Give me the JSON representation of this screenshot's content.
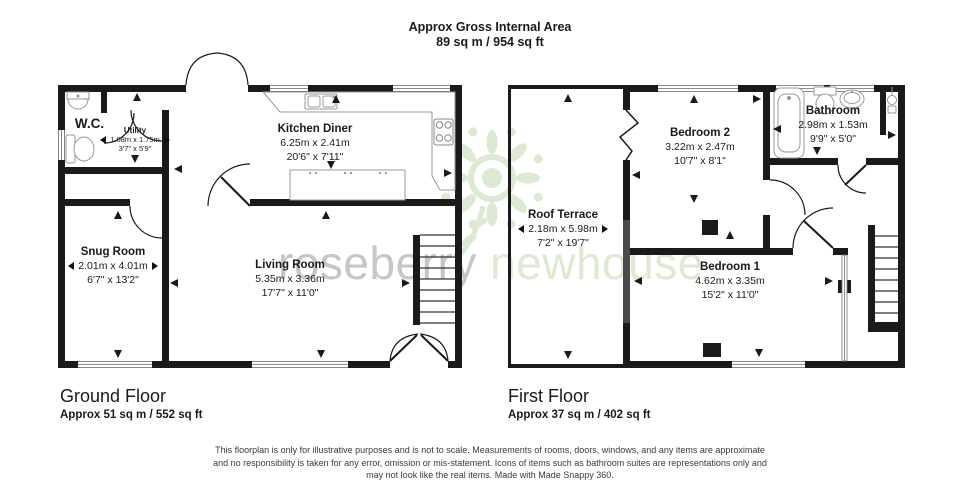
{
  "header": {
    "line1": "Approx Gross Internal Area",
    "line2": "89 sq m / 954 sq ft"
  },
  "watermark": {
    "brand_primary": "roseberry",
    "brand_secondary": "newhouse"
  },
  "ground_floor": {
    "title": "Ground Floor",
    "area": "Approx 51 sq m / 552 sq ft",
    "rooms": {
      "wc": {
        "name": "W.C."
      },
      "utility": {
        "name": "Utility",
        "metric": "1.08m x 1.75m",
        "imperial": "3'7\" x 5'9\""
      },
      "kitchen_diner": {
        "name": "Kitchen Diner",
        "metric": "6.25m x 2.41m",
        "imperial": "20'6\" x 7'11\""
      },
      "snug": {
        "name": "Snug Room",
        "metric": "2.01m x 4.01m",
        "imperial": "6'7\" x 13'2\""
      },
      "living": {
        "name": "Living Room",
        "metric": "5.35m x 3.36m",
        "imperial": "17'7\" x 11'0\""
      }
    }
  },
  "first_floor": {
    "title": "First Floor",
    "area": "Approx 37 sq m / 402 sq ft",
    "rooms": {
      "roof_terrace": {
        "name": "Roof Terrace",
        "metric": "2.18m x 5.98m",
        "imperial": "7'2\" x 19'7\""
      },
      "bedroom2": {
        "name": "Bedroom 2",
        "metric": "3.22m x 2.47m",
        "imperial": "10'7\" x 8'1\""
      },
      "bathroom": {
        "name": "Bathroom",
        "metric": "2.98m x 1.53m",
        "imperial": "9'9\" x 5'0\""
      },
      "bedroom1": {
        "name": "Bedroom 1",
        "metric": "4.62m x 3.35m",
        "imperial": "15'2\" x 11'0\""
      }
    }
  },
  "footer": {
    "line1": "This floorplan is only for illustrative purposes and is not to scale. Measurements of rooms, doors, windows, and any items are approximate",
    "line2": "and no responsibility is taken for any error, omission or mis-statement. Icons of items such as bathroom suites are representations only and",
    "line3": "may not look like the real items. Made with Made Snappy 360."
  },
  "colors": {
    "wall": "#1a1a1a",
    "parapet_gray": "#4a4a4a",
    "watermark_gray": "#c6c6c6",
    "watermark_green": "#dfe9d2",
    "fixture_outline": "#999999"
  }
}
